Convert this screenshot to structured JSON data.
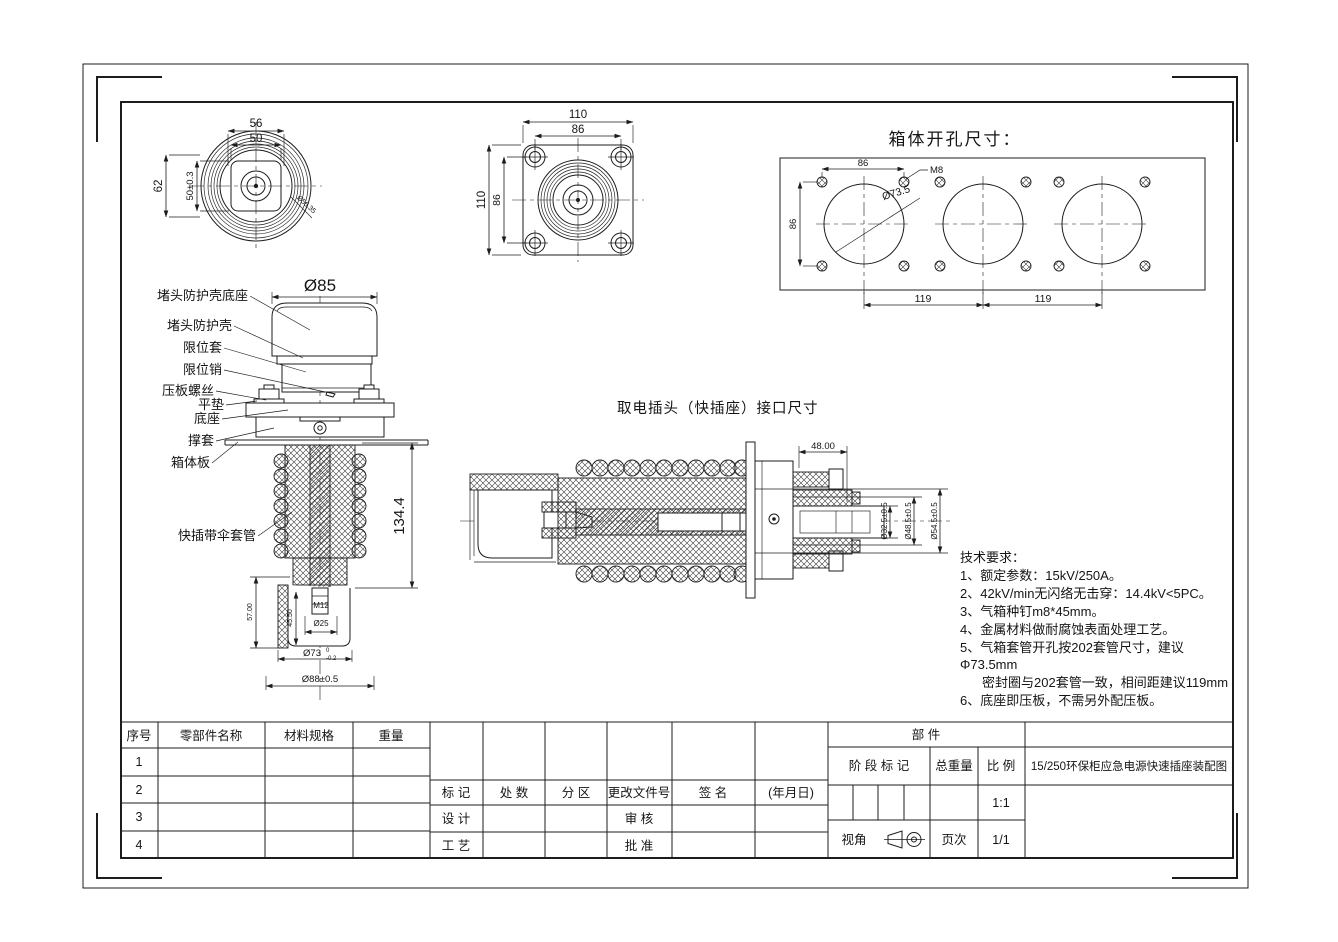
{
  "views": {
    "plug_top": {
      "dim_56": "56",
      "dim_50": "50",
      "dim_62": "62",
      "dim_50t": "50±0.3",
      "dim_diag": "Ø56.35"
    },
    "flange_top": {
      "dim_110_h": "110",
      "dim_86_h": "86",
      "dim_110_v": "110",
      "dim_86_v": "86"
    },
    "cutout": {
      "title": "箱体开孔尺寸：",
      "dim_86_h": "86",
      "dim_m8": "M8",
      "dim_d735": "Ø73.5",
      "dim_86_v": "86",
      "dim_119_l": "119",
      "dim_119_r": "119"
    },
    "front": {
      "dim_d85": "Ø85",
      "dim_1344": "134.4",
      "dim_57": "57.00",
      "dim_455": "45.50",
      "dim_m12": "M12",
      "dim_d25": "Ø25",
      "dim_d73_base": "Ø73",
      "dim_d73_up": "0",
      "dim_d73_low": "-0.2",
      "dim_d88": "Ø88±0.5",
      "labels": [
        "堵头防护壳底座",
        "堵头防护壳",
        "限位套",
        "限位销",
        "压板螺丝",
        "平垫",
        "底座",
        "撑套",
        "箱体板",
        "快插带伞套管"
      ]
    },
    "side": {
      "title": "取电插头（快插座）接口尺寸",
      "dim_48": "48.00",
      "dim_d325": "Ø32.5±0.5",
      "dim_d485": "Ø48.5±0.5",
      "dim_d545": "Ø54.5±0.5"
    }
  },
  "notes": {
    "lines": [
      "技术要求：",
      "1、额定参数：15kV/250A。",
      "2、42kV/min无闪络无击穿：14.4kV<5PC。",
      "3、气箱种钉m8*45mm。",
      "4、金属材料做耐腐蚀表面处理工艺。",
      "5、气箱套管开孔按202套管尺寸，建议",
      "Φ73.5mm",
      "密封圈与202套管一致，相间距建议119mm",
      "6、底座即压板，不需另外配压板。"
    ]
  },
  "table": {
    "parts_header": [
      "序号",
      "零部件名称",
      "材料规格",
      "重量"
    ],
    "rows": [
      "1",
      "2",
      "3",
      "4"
    ],
    "rev_header": [
      "标  记",
      "处  数",
      "分  区",
      "更改文件号",
      "签  名",
      "(年月日)"
    ],
    "row_design": {
      "c1": "设  计",
      "c2": "审  核"
    },
    "row_process": {
      "c1": "工  艺",
      "c2": "批  准"
    },
    "right": {
      "bujian": "部  件",
      "stage": "阶 段 标 记",
      "total_weight": "总重量",
      "scale_label": "比  例",
      "scale_value": "1:1",
      "title": "15/250环保柜应急电源快速插座装配图",
      "view_angle": "视角",
      "page_label": "页次",
      "page_value": "1/1"
    }
  }
}
